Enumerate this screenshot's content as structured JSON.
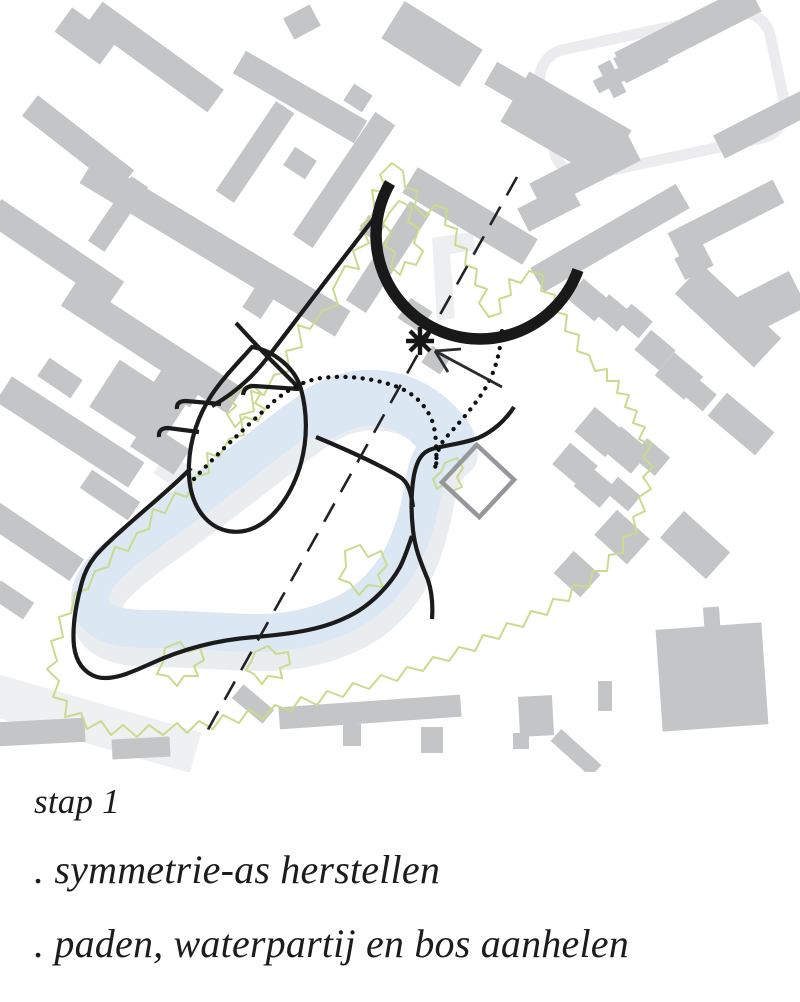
{
  "caption": {
    "step_label": "stap 1",
    "bullets": [
      ". symmetrie-as herstellen",
      ". paden, waterpartij en bos aanhelen"
    ]
  },
  "colors": {
    "background": "#ffffff",
    "building_gray": "#c3c5c7",
    "pale_gray": "#edeef0",
    "water_blue": "#dbe7f3",
    "water_shadow": "#eaedf0",
    "forest_green": "#c9db8d",
    "path_black": "#1b1b1b",
    "square_gray": "#95979a",
    "text_color": "#1c1c1e"
  },
  "map": {
    "viewbox": "0 0 800 772",
    "layers": [
      {
        "name": "pale-underlays",
        "shapes": [
          {
            "tag": "rect",
            "x": "545",
            "y": "30",
            "width": "235",
            "height": "128",
            "rx": "30",
            "fill": "none",
            "stroke": "#ececee",
            "stroke-width": "11",
            "transform": "rotate(-12 662 94)"
          },
          {
            "d": "M432,238 L472,232 476,250 450,254 455,318 437,321 Z",
            "fill": "#eceef0"
          },
          {
            "tag": "rect",
            "x": "-30",
            "y": "700",
            "width": "230",
            "height": "42",
            "fill": "#eef0f1",
            "transform": "rotate(16 85 721)"
          },
          {
            "tag": "rect",
            "x": "157",
            "y": "462",
            "width": "46",
            "height": "26",
            "fill": "#eceef0",
            "transform": "rotate(33 180 475)"
          }
        ]
      },
      {
        "name": "buildings",
        "fill": "#c3c5c7",
        "rects": [
          [
            155,
            57,
            150,
            28,
            36
          ],
          [
            300,
            97,
            140,
            26,
            30
          ],
          [
            86,
            36,
            56,
            30,
            36
          ],
          [
            432,
            44,
            92,
            44,
            32
          ],
          [
            566,
            126,
            118,
            58,
            30
          ],
          [
            78,
            143,
            122,
            26,
            38
          ],
          [
            215,
            247,
            298,
            30,
            31
          ],
          [
            344,
            180,
            148,
            24,
            -56
          ],
          [
            470,
            216,
            140,
            30,
            31
          ],
          [
            610,
            238,
            168,
            28,
            -30
          ],
          [
            55,
            252,
            148,
            28,
            34
          ],
          [
            118,
            214,
            78,
            20,
            -56
          ],
          [
            152,
            347,
            198,
            30,
            33
          ],
          [
            70,
            432,
            158,
            30,
            33
          ],
          [
            138,
            405,
            80,
            56,
            33
          ],
          [
            32,
            540,
            108,
            26,
            34
          ],
          [
            255,
            152,
            108,
            22,
            -56
          ],
          [
            388,
            257,
            118,
            24,
            -57
          ],
          [
            300,
            163,
            26,
            22,
            33
          ],
          [
            358,
            98,
            22,
            20,
            33
          ],
          [
            258,
            303,
            24,
            22,
            -57
          ],
          [
            415,
            315,
            26,
            24,
            33
          ],
          [
            436,
            360,
            22,
            20,
            33
          ],
          [
            302,
            22,
            30,
            24,
            -28
          ],
          [
            372,
            228,
            20,
            18,
            33
          ],
          [
            508,
            83,
            40,
            26,
            30
          ],
          [
            180,
            382,
            44,
            32,
            33
          ],
          [
            160,
            448,
            52,
            30,
            33
          ],
          [
            110,
            495,
            58,
            22,
            34
          ],
          [
            60,
            378,
            40,
            22,
            34
          ],
          [
            12,
            600,
            40,
            20,
            34
          ],
          [
            688,
            32,
            150,
            30,
            -27
          ],
          [
            776,
            118,
            128,
            26,
            -27
          ],
          [
            612,
            79,
            36,
            14,
            -27
          ],
          [
            612,
            79,
            14,
            36,
            -27
          ],
          [
            585,
            172,
            110,
            30,
            -27
          ],
          [
            549,
            207,
            58,
            26,
            -27
          ],
          [
            726,
            218,
            118,
            26,
            -27
          ],
          [
            694,
            262,
            32,
            24,
            -27
          ],
          [
            772,
            302,
            58,
            40,
            -27
          ],
          [
            728,
            316,
            108,
            40,
            43
          ],
          [
            641,
            60,
            48,
            28,
            -27
          ],
          [
            589,
            300,
            36,
            26,
            40
          ],
          [
            613,
            313,
            30,
            24,
            40
          ],
          [
            635,
            321,
            28,
            22,
            40
          ],
          [
            655,
            350,
            32,
            26,
            40
          ],
          [
            679,
            376,
            38,
            30,
            40
          ],
          [
            699,
            394,
            28,
            22,
            40
          ],
          [
            741,
            424,
            62,
            30,
            40
          ],
          [
            600,
            432,
            40,
            32,
            40
          ],
          [
            626,
            450,
            38,
            30,
            40
          ],
          [
            651,
            457,
            30,
            24,
            40
          ],
          [
            575,
            465,
            36,
            28,
            40
          ],
          [
            595,
            487,
            34,
            26,
            40
          ],
          [
            623,
            494,
            30,
            20,
            40
          ],
          [
            622,
            537,
            44,
            34,
            42
          ],
          [
            695,
            545,
            62,
            36,
            42
          ],
          [
            577,
            574,
            36,
            30,
            42
          ],
          [
            712,
            622,
            16,
            30,
            -4
          ],
          [
            712,
            677,
            106,
            102,
            -4
          ],
          [
            370,
            712,
            182,
            22,
            -4
          ],
          [
            352,
            735,
            18,
            22,
            0
          ],
          [
            432,
            740,
            22,
            26,
            0
          ],
          [
            536,
            716,
            34,
            40,
            -3
          ],
          [
            521,
            741,
            16,
            16,
            0
          ],
          [
            576,
            753,
            54,
            16,
            42
          ],
          [
            605,
            696,
            14,
            30,
            0
          ],
          [
            42,
            732,
            86,
            24,
            -3
          ],
          [
            141,
            748,
            58,
            20,
            -3
          ],
          [
            253,
            704,
            40,
            18,
            40
          ]
        ]
      },
      {
        "name": "water-shadow",
        "transform": "translate(6 13)",
        "shapes": [
          {
            "d": "M447,441 C436,420 422,406 402,398 C380,390 352,390 330,400 C310,409 290,425 268,442 C240,464 210,487 180,509 C152,530 122,549 103,570 C90,585 86,602 95,614 C104,625 122,629 146,629 C180,629 215,632 250,633 C285,634 318,627 346,613 C370,601 390,580 403,555 C413,535 420,508 424,484 C427,465 432,452 447,441 Z",
            "fill": "none",
            "stroke": "#eaedf0",
            "stroke-width": "50",
            "stroke-linejoin": "round"
          }
        ]
      },
      {
        "name": "water",
        "shapes": [
          {
            "d": "M447,441 C430,415 405,400 375,398 C355,397 340,402 322,412",
            "fill": "none",
            "stroke": "#dbe7f3",
            "stroke-width": "56",
            "stroke-linecap": "round"
          },
          {
            "d": "M447,441 C436,420 422,406 402,398 C380,390 352,390 330,400 C310,409 290,425 268,442 C240,464 210,487 180,509 C152,530 122,549 103,570 C90,585 86,602 95,614 C104,625 122,629 146,629 C180,629 215,632 250,633 C285,634 318,627 346,613 C370,601 390,580 403,555 C413,535 420,508 424,484 C427,465 432,452 447,441 Z",
            "fill": "none",
            "stroke": "#dbe7f3",
            "stroke-width": "38",
            "stroke-linejoin": "round"
          }
        ]
      },
      {
        "name": "forest-boundary",
        "shapes": [
          {
            "d": "M392,163 L380,175 388,193 372,190 375,212 361,226 369,243 353,251 359,269 345,266 333,289 338,305 322,311 310,329 298,325 302,347 286,351 290,371 274,375 264,395 251,391 254,411 240,415 244,435 229,439 219,457 207,453 209,473 195,477 187,497 175,493 165,513 153,509 149,529 137,533 128,551 115,547 108,567 95,571 88,589 75,593 71,613 59,617 63,637 51,641 57,661 47,669 59,681 53,697 67,701 65,717 81,713 87,729 101,721 111,735 123,725 137,737 149,725 163,735 177,723 187,733 199,721 213,729 223,715 239,723 249,709 263,719 275,705 291,711 301,697 317,705 327,691 343,697 353,683 369,689 381,675 397,681 407,667 423,671 433,657 449,661 459,647 475,651 483,635 499,639 507,623 523,627 531,611 547,615 553,599 569,601 573,585 589,587 593,571 607,571 609,555 623,553 623,537 637,533 633,517 645,511 639,497 651,489 643,477 653,467 643,457 651,445 639,439 645,427 633,423 637,411 625,407 629,395 617,393 619,381 607,381 607,369 595,371 589,355 577,351 579,335 565,331 567,315 553,311 555,295 541,291 543,275 529,271 521,283 509,279 511,295 499,299 501,313 489,317 479,303 487,289 475,285 477,269 465,265 467,249 455,245 457,229 445,225 447,209 435,205 425,217 415,207 417,191 405,187 403,171 Z",
            "fill": "none",
            "stroke": "#c9db8d",
            "stroke-width": "2",
            "stroke-linejoin": "round"
          },
          {
            "d": "M236,392 L251,384 261,393 255,403 265,409 258,421 245,417 235,427 227,414 236,406 229,398 Z",
            "fill": "none",
            "stroke": "#c9db8d",
            "stroke-width": "2"
          },
          {
            "d": "M399,201 L412,207 408,222 419,228 414,243 423,251 416,265 405,262 400,275 391,267 395,252 385,246 391,232 383,224 390,212 Z",
            "fill": "none",
            "stroke": "#c9db8d",
            "stroke-width": "2"
          },
          {
            "d": "M345,551 L360,545 368,557 381,551 387,565 378,575 383,587 368,585 359,595 350,583 339,579 346,567 Z",
            "fill": "none",
            "stroke": "#c9db8d",
            "stroke-width": "2"
          },
          {
            "d": "M445,463 L457,458 463,468 457,477 462,487 452,491 444,484 437,489 433,479 441,472 Z",
            "fill": "none",
            "stroke": "#c9db8d",
            "stroke-width": "2"
          },
          {
            "d": "M165,648 L180,642 188,652 200,648 204,660 194,666 198,676 184,676 177,686 168,676 157,674 163,662 Z",
            "fill": "none",
            "stroke": "#c9db8d",
            "stroke-width": "2"
          },
          {
            "d": "M255,652 L268,646 276,654 288,652 290,664 280,668 282,678 268,676 262,684 254,674 246,670 252,660 Z",
            "fill": "none",
            "stroke": "#c9db8d",
            "stroke-width": "2"
          }
        ]
      },
      {
        "name": "plot-square",
        "shapes": [
          {
            "tag": "rect",
            "x": "452.5",
            "y": "455.5",
            "width": "51",
            "height": "51",
            "fill": "none",
            "stroke": "#95979a",
            "stroke-width": "4.5",
            "transform": "rotate(43 478 481)"
          }
        ]
      },
      {
        "name": "paths-black",
        "shapes": [
          {
            "d": "M252,347 C272,350 295,367 301,389 C307,411 308,437 301,463 C293,492 276,517 256,527 C238,536 218,532 205,518 C193,505 188,486 189,464 C190,440 198,416 211,396 C222,379 237,364 252,347 Z",
            "fill": "none",
            "stroke": "#1b1b1b",
            "stroke-width": "4.2"
          },
          {
            "d": "M388,190 C383,203 379,211 372,221 C340,262 300,315 268,357 C248,383 228,397 212,406",
            "fill": "none",
            "stroke": "#1b1b1b",
            "stroke-width": "4.2"
          },
          {
            "d": "M236,323 C247,335 257,346 268,357 C279,368 289,378 300,389",
            "fill": "none",
            "stroke": "#1b1b1b",
            "stroke-width": "4.2"
          },
          {
            "d": "M243,395 Q244,386 254,386 L299,389",
            "fill": "none",
            "stroke": "#1b1b1b",
            "stroke-width": "4.2"
          },
          {
            "d": "M177,409 Q176,401 186,401 L221,404",
            "fill": "none",
            "stroke": "#1b1b1b",
            "stroke-width": "4.2"
          },
          {
            "d": "M159,437 Q158,428 168,428 L199,432",
            "fill": "none",
            "stroke": "#1b1b1b",
            "stroke-width": "4.2"
          },
          {
            "d": "M316,437 C340,447 375,462 400,477 C408,482 411,492 413,507",
            "fill": "none",
            "stroke": "#1b1b1b",
            "stroke-width": "4.2"
          },
          {
            "d": "M514,407 C505,421 492,432 478,438 C462,444 446,445 432,449 C422,452 417,460 414,475 C411,492 411,512 413,530 C415,550 422,565 428,580 C432,592 433,605 432,619",
            "fill": "none",
            "stroke": "#1b1b1b",
            "stroke-width": "4.2"
          },
          {
            "d": "M191,468 C175,485 150,505 122,530 C100,550 88,560 82,582 C76,604 72,628 74,646 C76,662 84,673 97,677 C112,681 130,673 150,664 C180,650 215,640 255,637 C290,634 320,630 345,618 C370,607 390,585 400,567 C406,555 409,544 412,536",
            "fill": "none",
            "stroke": "#1b1b1b",
            "stroke-width": "4.2"
          }
        ]
      },
      {
        "name": "dotted-paths",
        "shapes": [
          {
            "d": "M194,479 C215,456 245,428 272,403 C288,389 305,380 322,378 C345,375 372,378 395,386 C412,392 424,403 431,418 C436,429 437,448 436,470",
            "fill": "none",
            "stroke": "#111111",
            "stroke-width": "4.3",
            "stroke-linecap": "round",
            "stroke-dasharray": "0.1 8.5"
          },
          {
            "d": "M502,331 C500,355 494,375 483,392 C470,412 454,428 444,440 C439,446 436,455 435,470",
            "fill": "none",
            "stroke": "#111111",
            "stroke-width": "4.3",
            "stroke-linecap": "round",
            "stroke-dasharray": "0.1 8.5"
          }
        ]
      },
      {
        "name": "symmetry-axis",
        "shapes": [
          {
            "tag": "line",
            "x1": "517",
            "y1": "177",
            "x2": "206",
            "y2": "733",
            "stroke": "#222222",
            "stroke-width": "2.6",
            "stroke-dasharray": "21 13"
          }
        ]
      },
      {
        "name": "entrance-arc",
        "shapes": [
          {
            "d": "M390,183 A104 104 0 1 0 578,270",
            "fill": "none",
            "stroke": "#191919",
            "stroke-width": "11.5"
          }
        ]
      },
      {
        "name": "focus-marker",
        "shapes": [
          {
            "tag": "line",
            "x1": "420",
            "y1": "327",
            "x2": "420",
            "y2": "355",
            "stroke": "#161616",
            "stroke-width": "4.4"
          },
          {
            "tag": "line",
            "x1": "406",
            "y1": "341",
            "x2": "434",
            "y2": "341",
            "stroke": "#161616",
            "stroke-width": "4.4"
          },
          {
            "tag": "line",
            "x1": "410",
            "y1": "331",
            "x2": "430",
            "y2": "351",
            "stroke": "#161616",
            "stroke-width": "4.4"
          },
          {
            "tag": "line",
            "x1": "410",
            "y1": "351",
            "x2": "430",
            "y2": "331",
            "stroke": "#161616",
            "stroke-width": "4.4"
          },
          {
            "tag": "line",
            "x1": "502",
            "y1": "387",
            "x2": "435",
            "y2": "351",
            "stroke": "#2a2a2a",
            "stroke-width": "2.8"
          },
          {
            "tag": "line",
            "x1": "435",
            "y1": "351",
            "x2": "461",
            "y2": "349",
            "stroke": "#2a2a2a",
            "stroke-width": "2.8"
          },
          {
            "tag": "line",
            "x1": "435",
            "y1": "351",
            "x2": "448",
            "y2": "372",
            "stroke": "#2a2a2a",
            "stroke-width": "2.8"
          }
        ]
      }
    ]
  }
}
